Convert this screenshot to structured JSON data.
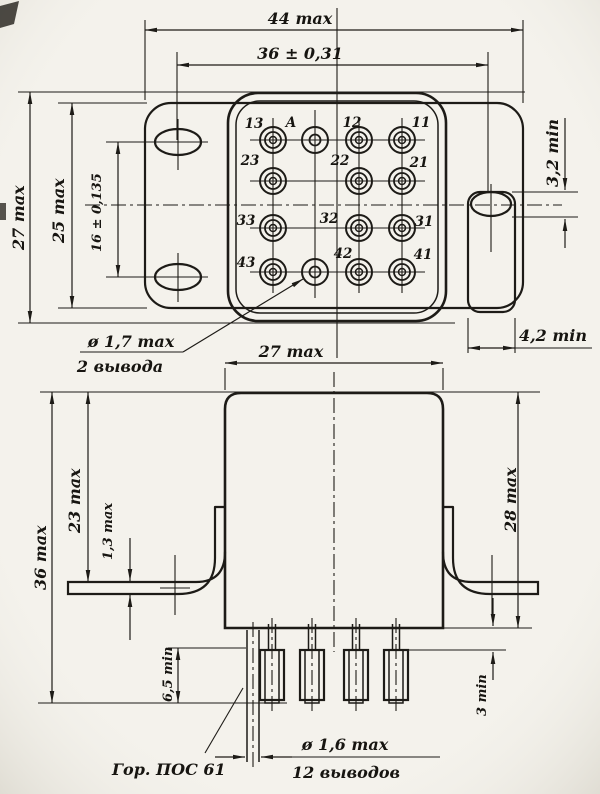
{
  "drawing_type": "relay outline technical drawing",
  "colors": {
    "paper": "#f4f2ec",
    "ink": "#1d1b17"
  },
  "top_view": {
    "dims": {
      "overall_width": "44 max",
      "hole_span": "36 ± 0,31",
      "overall_height": "27 max",
      "flange_height": "25 max",
      "hole_pitch": "16 ± 0,135",
      "slot_height": "3,2 min",
      "tab_width": "4,2 min"
    },
    "callout_coil_pins": {
      "line1": "ø 1,7 max",
      "line2": "2 вывода"
    },
    "pins": {
      "p13": "13",
      "pA": "A",
      "p12": "12",
      "p11": "11",
      "p23": "23",
      "p22": "22",
      "p21": "21",
      "p33": "33",
      "p32": "32",
      "p31": "31",
      "p43": "43",
      "p42": "42",
      "p41": "41"
    }
  },
  "front_view": {
    "dims": {
      "body_width": "27 max",
      "height_to_flange": "23 max",
      "flange_thickness": "1,3 max",
      "overall_height": "36 max",
      "body_height": "28 max",
      "pin_free_length": "6,5 min",
      "sleeve_length": "3 min"
    },
    "callout_solder": "Гор. ПОС 61",
    "callout_contact_pins": {
      "line1": "ø 1,6 max",
      "line2": "12 выводов"
    }
  }
}
